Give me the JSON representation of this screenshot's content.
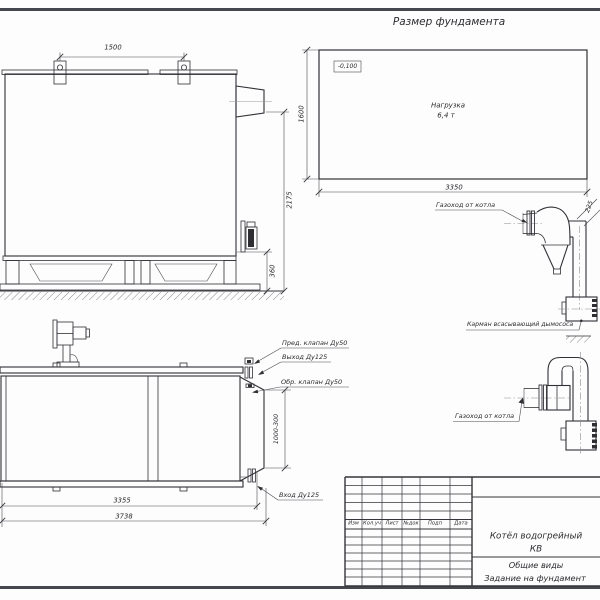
{
  "colors": {
    "ink": "#303036",
    "sheet_border": "#46464e"
  },
  "titles": {
    "foundation": "Размер фундамента"
  },
  "foundation_plan": {
    "elevation_mark": "-0,100",
    "load_line1": "Нагрузка",
    "load_line2": "6,4 т",
    "dim_width": "3350",
    "dim_height": "1600"
  },
  "side_view": {
    "dim_lug_spacing": "1500",
    "dim_height": "2175",
    "dim_base_height": "360"
  },
  "front_view": {
    "label_safety_valve": "Пред. клапан Ду50",
    "label_outlet": "Выход Ду125",
    "label_check_valve": "Обр. клапан Ду50",
    "label_inlet": "Вход Ду125",
    "dim_length_body": "3355",
    "dim_length_total": "3738",
    "dim_flue_box": "1000-300"
  },
  "flue_detail_upper": {
    "label_duct": "Газоход от котла",
    "label_pocket": "Карман всасывающий дымососа",
    "dim_offset": "225"
  },
  "flue_detail_lower": {
    "label_duct": "Газоход от котла"
  },
  "title_block": {
    "columns": [
      "Изм",
      "Кол.уч",
      "Лист",
      "№док",
      "Подп",
      "Дата"
    ],
    "product_line1": "Котёл водогрейный",
    "product_line2": "КВ",
    "doc_line1": "Общие виды",
    "doc_line2": "Задание на фундамент"
  }
}
